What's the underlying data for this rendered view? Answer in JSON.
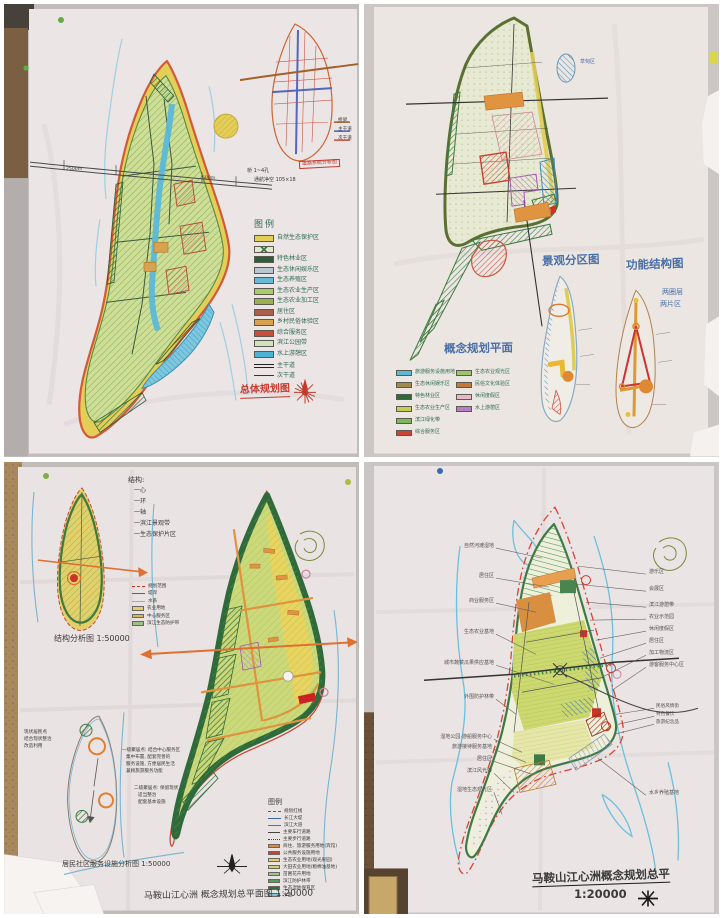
{
  "palette": {
    "wall": "#c9c4c3",
    "paper": "#ebe5e6",
    "cork": "#a8885f",
    "island_outline_red": "#d4593a",
    "island_yellow_band": "#e3cf57",
    "island_green": "#cede96",
    "water_blue": "#5bb8d8",
    "river_blue": "#9fd0e0",
    "road_dark": "#444444",
    "marker_red": "#c23a2b",
    "marker_blue": "#4a6fa5",
    "marker_green": "#2d6b4f",
    "orange_road": "#e0933f"
  },
  "q1": {
    "legend_title": "图例",
    "legend_items": [
      {
        "label": "自然生态保护区",
        "color": "#e3cf57",
        "type": "swatch"
      },
      {
        "label": "",
        "color": "#3f7a3d",
        "type": "swatch-x"
      },
      {
        "label": "特色林业区",
        "color": "#2f5d3a",
        "type": "swatch"
      },
      {
        "label": "生态休闲娱乐区",
        "color": "#b9c6cf",
        "type": "swatch"
      },
      {
        "label": "生态养殖区",
        "color": "#66b8d6",
        "type": "swatch"
      },
      {
        "label": "生态农业生产区",
        "color": "#abcb69",
        "type": "swatch"
      },
      {
        "label": "生态农业加工区",
        "color": "#9fae52",
        "type": "swatch"
      },
      {
        "label": "居住区",
        "color": "#a8604a",
        "type": "swatch"
      },
      {
        "label": "乡村民俗体验区",
        "color": "#d8a24e",
        "type": "swatch"
      },
      {
        "label": "综合服务区",
        "color": "#c94f3d",
        "type": "swatch"
      },
      {
        "label": "滨江公园带",
        "color": "#cfe3c0",
        "type": "swatch"
      },
      {
        "label": "水上游憩区",
        "color": "#4db3d4",
        "type": "swatch"
      },
      {
        "label": "主干道",
        "type": "line-double"
      },
      {
        "label": "次干道",
        "type": "line-single"
      }
    ],
    "title": "总体规划图",
    "inset_title": "道路系统分析图",
    "inset_legend": [
      "桥梁",
      "主干道",
      "次干道"
    ],
    "bridge_note1": "桥 1~4孔",
    "bridge_note2": "通航净空 105×18",
    "dim_left": "2500m",
    "dim_mid": "500m"
  },
  "q2": {
    "plan_title": "概念规划平面",
    "diagram1_title": "景观分区图",
    "diagram2_title": "功能结构图",
    "structure_note1": "两圈层",
    "structure_note2": "两片区",
    "blob_label": "草甸区",
    "legend_left": [
      {
        "label": "旅游服务设施用地",
        "color": "#5bb8d6"
      },
      {
        "label": "生态休闲娱乐区",
        "color": "#a08a4a"
      },
      {
        "label": "特色林业区",
        "color": "#2f6b3a"
      },
      {
        "label": "生态农业生产区",
        "color": "#c6cc55"
      },
      {
        "label": "滨江绿化带",
        "color": "#7ab85a"
      },
      {
        "label": "综合服务区",
        "color": "#cc4433"
      }
    ],
    "legend_right": [
      {
        "label": "生态农业观光区",
        "color": "#9cc46a"
      },
      {
        "label": "民俗文化体验区",
        "color": "#c07a3a"
      },
      {
        "label": "休闲度假区",
        "color": "#e8b8c8"
      },
      {
        "label": "水上游憩区",
        "color": "#b57fc4"
      }
    ]
  },
  "q3": {
    "notes_title": "结构:",
    "notes": [
      "一心",
      "一环",
      "一轴",
      "一滨江景观带",
      "一生态保护片区"
    ],
    "map1_title": "结构分析图 1:50000",
    "mini_legend": [
      {
        "label": "规划范围",
        "type": "dash-red"
      },
      {
        "label": "堤岸",
        "type": "line-blue"
      },
      {
        "label": "水系",
        "type": "line-cyan"
      },
      {
        "label": "农业用地",
        "color": "#e3d06a"
      },
      {
        "label": "中心服务区",
        "color": "#d4b85a"
      },
      {
        "label": "滨江生态防护带",
        "color": "#9fbf85"
      }
    ],
    "map2_title": "居民社区服务设施分析图 1:50000",
    "note_block1": [
      "现状居民点",
      "结合现状整治",
      "改造利用"
    ],
    "note_block2": [
      "一级聚居点: 结合中心服务区",
      "集中布置, 配套完善的",
      "服务设施, 方便居民生活",
      "兼顾旅游服务功能"
    ],
    "note_block3": [
      "二级聚居点: 保留现状",
      "适当整治",
      "配套基本设施"
    ],
    "legend_title": "图例",
    "legend_items": [
      {
        "label": "规划红线",
        "type": "dash-red"
      },
      {
        "label": "长江大堤",
        "type": "line-blue"
      },
      {
        "label": "滨江大道",
        "type": "line-brown"
      },
      {
        "label": "主要车行道路",
        "type": "line-gray"
      },
      {
        "label": "主要步行道路",
        "type": "line-gray2"
      },
      {
        "label": "商住、旅游服务用地(宾馆)",
        "color": "#d98c3f"
      },
      {
        "label": "公共服务设施用地",
        "color": "#cc4433"
      },
      {
        "label": "生态农业用地(观光果园)",
        "color": "#e3d06a"
      },
      {
        "label": "大田农业用地(粮棉油基地)",
        "color": "#c6d477"
      },
      {
        "label": "苗圃花卉用地",
        "color": "#9cc48f"
      },
      {
        "label": "滨江防护林带",
        "color": "#4f9e5f"
      },
      {
        "label": "生态湿地保育区",
        "color": "#2f6e4a"
      },
      {
        "label": "水面",
        "color": "#77c4d4"
      }
    ],
    "main_title": "马鞍山江心洲 概念规划总平面图 1:20000"
  },
  "q4": {
    "left_labels": [
      "自然河滩湿地",
      "居住区",
      "商业服务区",
      "生态农业基地",
      "城市蔬菜瓜果供应基地",
      "外围防护林带",
      "湿地公园·游船服务中心",
      "旅游接待服务基地",
      "居住区",
      "滨江风光带",
      "湿地生态观光区"
    ],
    "right_labels": [
      "游乐区",
      "会展区",
      "滨江游憩带",
      "农业示范园",
      "休闲度假区",
      "居住区",
      "加工物流区",
      "游客服务中心区",
      "水乡养殖基地"
    ],
    "right_sub_labels": [
      "民俗风情街",
      "特色餐饮",
      "旅游纪念品"
    ],
    "title": "马鞍山江心洲概念规划总平",
    "scale_text": "1:20000"
  }
}
